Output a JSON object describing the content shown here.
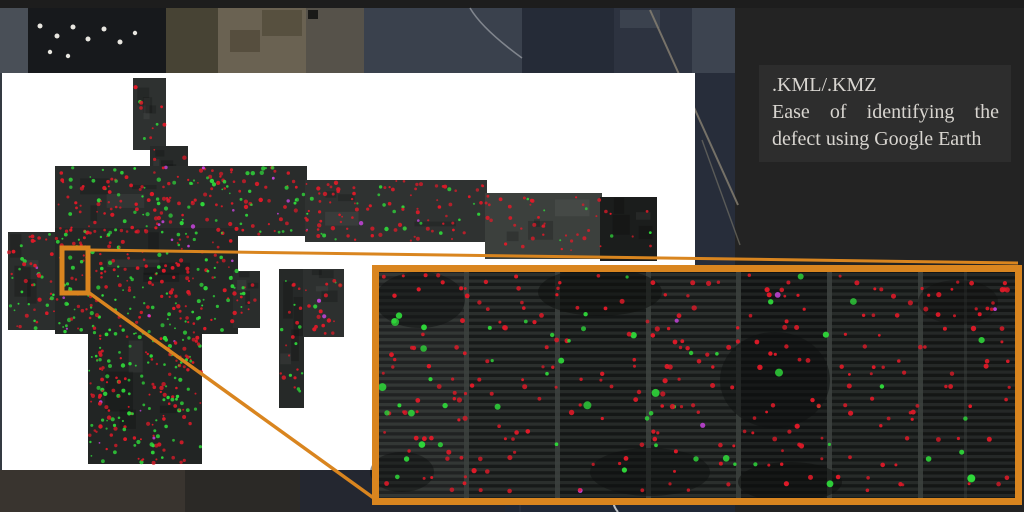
{
  "caption": {
    "title": ".KML/.KMZ",
    "body": "Ease of identifying the defect using Google Earth"
  },
  "colors": {
    "slide_bg": "#232323",
    "top_bar": "#1d1d1d",
    "caption_bg": "#2d2d2d",
    "caption_text": "#d8d5d0",
    "accent_orange": "#d9851f",
    "map_background": "#ffffff",
    "defect_red": "#e01a28",
    "defect_green": "#2fd83a",
    "defect_magenta": "#c944e0"
  }
}
